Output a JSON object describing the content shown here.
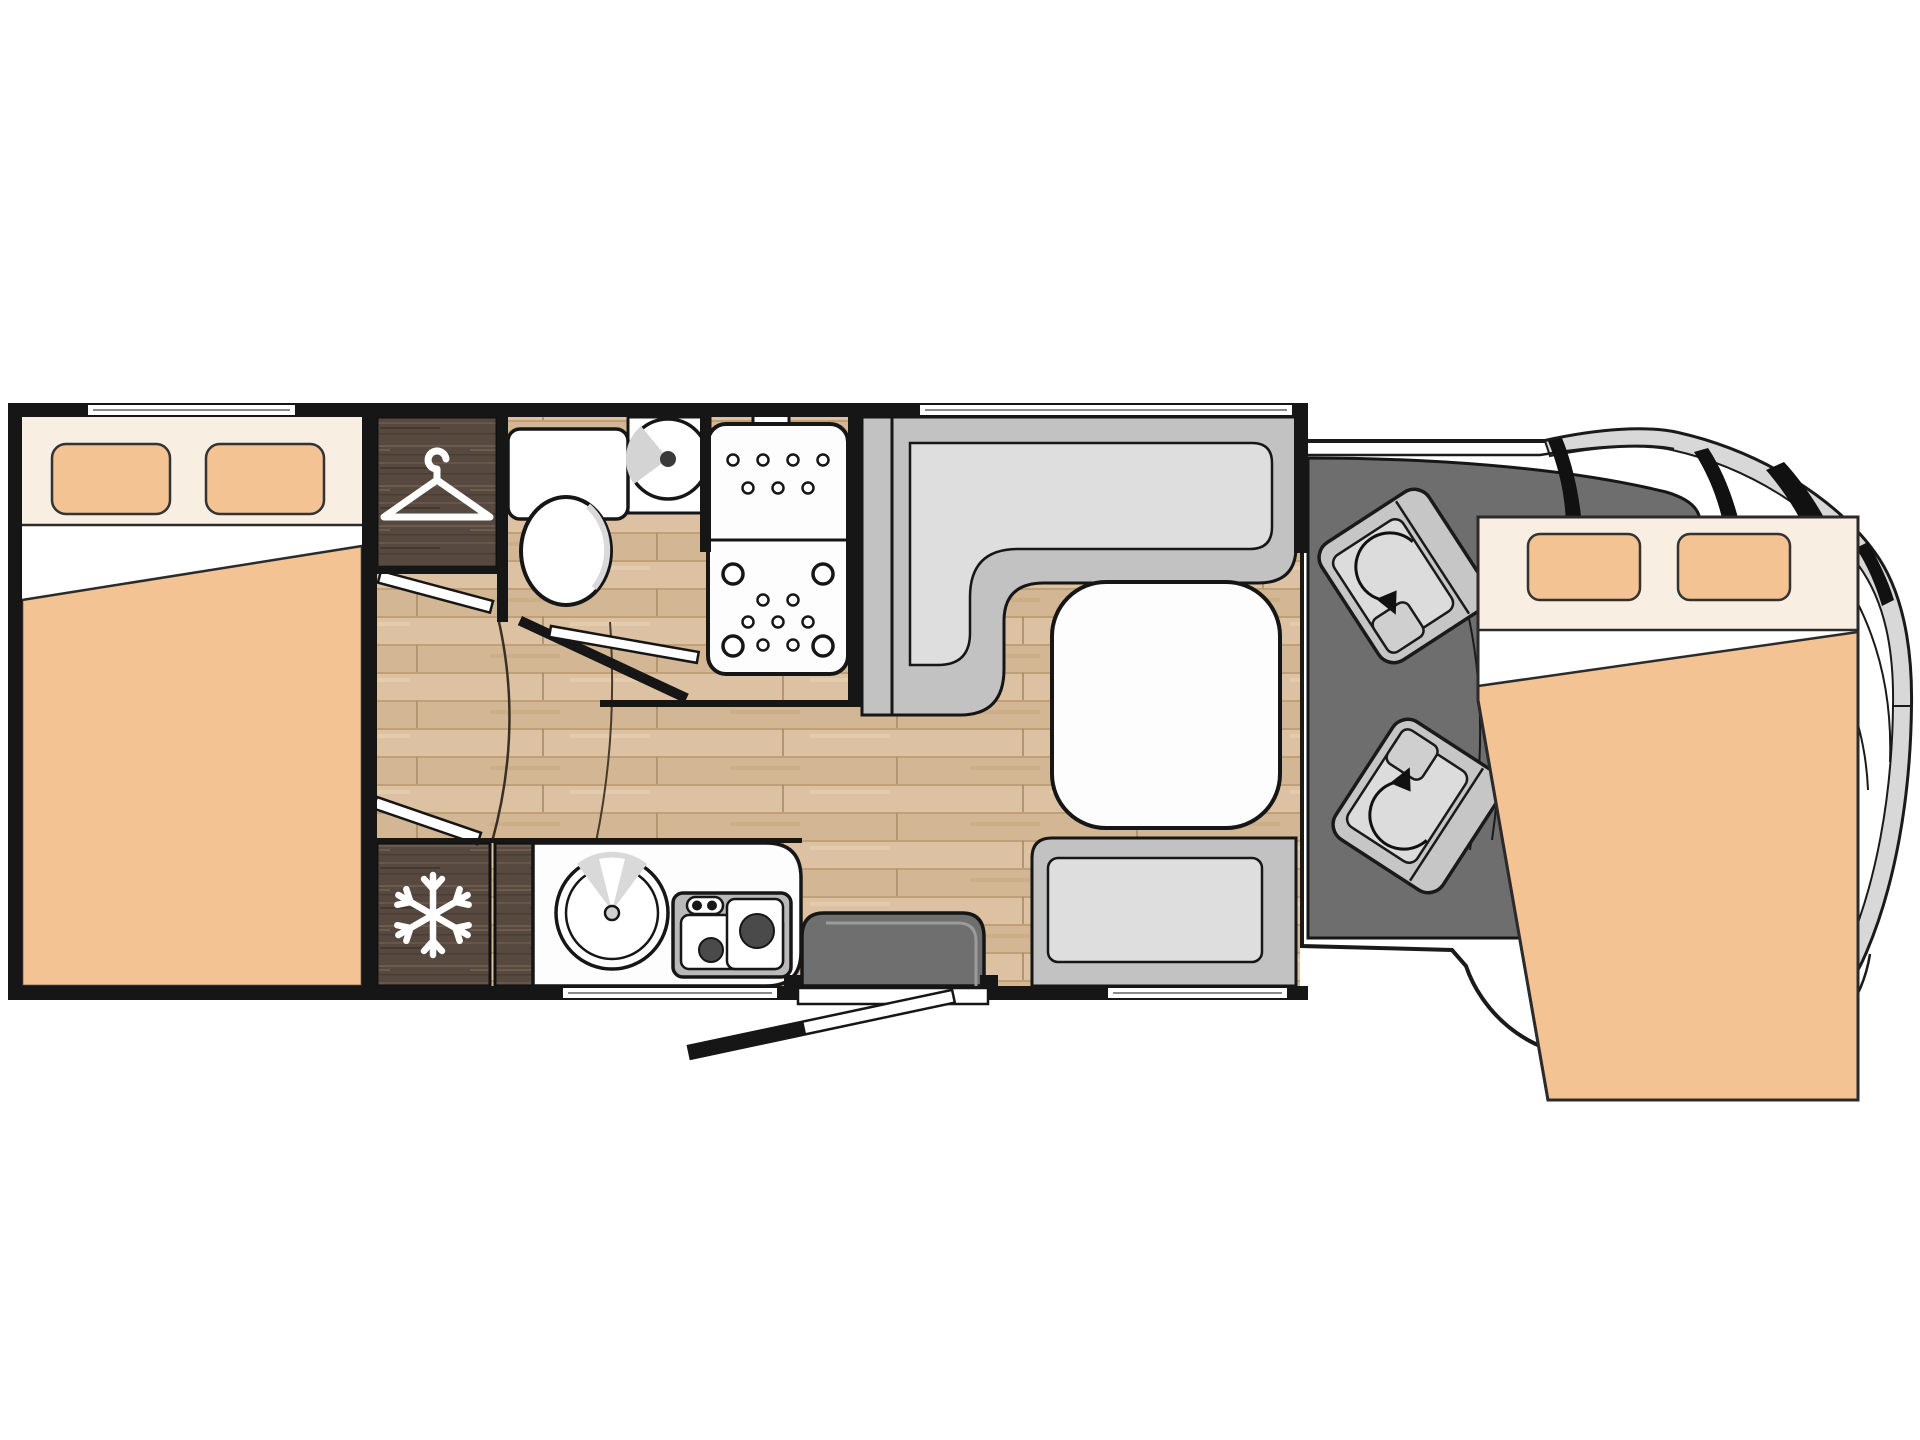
{
  "meta": {
    "title": "Motorhome floor plan (top view)",
    "description": "Coachbuilt camper layout: rear double bed, wardrobe, fridge, bathroom with toilet and basin, separate shower, kitchen with sink and 2-burner hob, L-shaped dinette with table and side bench, entrance step, cab with two swivel seats and drop-down front double bed",
    "canvas": {
      "width": 1920,
      "height": 1440
    }
  },
  "colors": {
    "wall": "#161616",
    "outline": "#1a1a1a",
    "bedding_peach": "#F3C394",
    "sheet_cream": "#F8EEE2",
    "sheet_white": "#FFFFFF",
    "wood_light": "#D8BD9C",
    "wood_dark": "#57493F",
    "bench_gray": "#C2C2C2",
    "cushion_gray": "#DEDEDE",
    "cab_floor_gray": "#6E6E6E",
    "seat_base_gray": "#C6C6C6",
    "seat_cushion_gray": "#DCDCDC",
    "body_rim_gray": "#D8D8D8",
    "step_gray": "#6F6F6F",
    "surface_white": "#FDFDFD",
    "hob_gray": "#B9B9B9",
    "burner_dark": "#4A4A4A"
  },
  "zones": {
    "rear_bedroom": {
      "name": "rear-double-bed",
      "features": [
        "headboard",
        "pillow-left",
        "pillow-right",
        "folded-blanket",
        "window"
      ]
    },
    "wardrobe": {
      "name": "wardrobe",
      "icon": "hanger-icon"
    },
    "fridge": {
      "name": "refrigerator",
      "icon": "snowflake-icon"
    },
    "bathroom": {
      "name": "washroom",
      "features": [
        "toilet",
        "cistern",
        "washbasin"
      ]
    },
    "shower": {
      "name": "shower-cubicle",
      "features": [
        "shower-head",
        "drain-dots"
      ]
    },
    "kitchen": {
      "name": "kitchen-block",
      "features": [
        "round-sink",
        "two-burner-hob",
        "control-knobs"
      ]
    },
    "dinette": {
      "name": "dinette",
      "features": [
        "l-shaped-bench",
        "dining-table",
        "side-bench",
        "window"
      ]
    },
    "entrance": {
      "name": "entrance-door",
      "features": [
        "step-well",
        "threshold",
        "door-leaf"
      ]
    },
    "cab": {
      "name": "driver-cab",
      "features": [
        "driver-swivel-seat",
        "passenger-swivel-seat",
        "rotation-arrows",
        "windshield",
        "a-pillars",
        "body-outline"
      ]
    },
    "front_bed": {
      "name": "drop-down-front-bed",
      "features": [
        "pillow-left",
        "pillow-right",
        "folded-blanket"
      ]
    }
  },
  "icons": [
    "hanger-icon",
    "snowflake-icon",
    "rotation-arrow-icon",
    "shower-head-icon"
  ]
}
